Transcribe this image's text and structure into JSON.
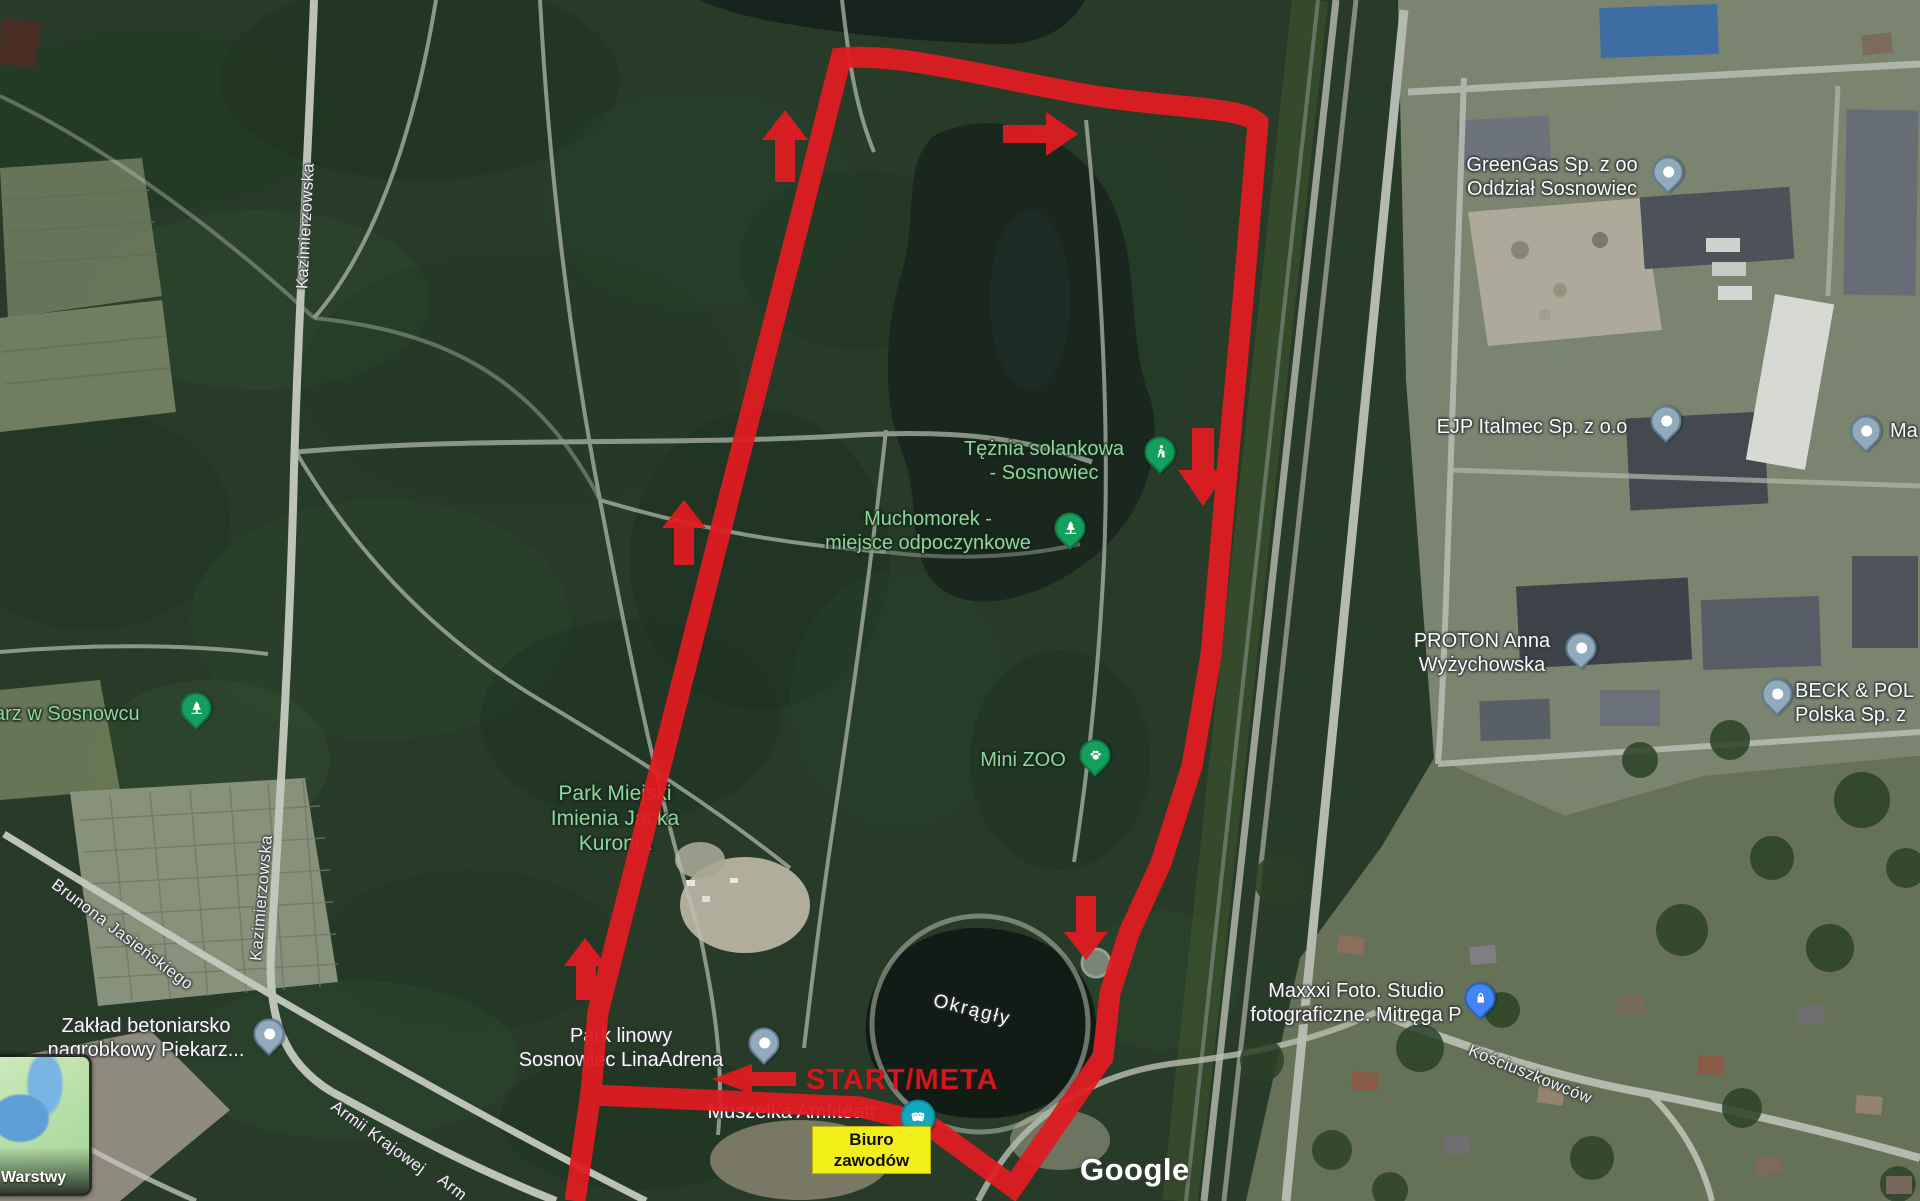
{
  "map": {
    "streets": {
      "kazimierzowska": "Kazimierzowska",
      "brunona_jasienskiego": "Brunona Jasieńskiego",
      "armii_krajowej": "Armii Krajowej",
      "armii_partial": "Arm",
      "kosciuszkowcow": "Kościuszkowców"
    },
    "places": {
      "greengas": {
        "line1": "GreenGas Sp. z oo",
        "line2": "Oddział Sosnowiec"
      },
      "ejp": {
        "line1": "EJP Italmec Sp. z o.o"
      },
      "ma_partial": {
        "line1": "Ma"
      },
      "proton": {
        "line1": "PROTON Anna",
        "line2": "Wyżychowska"
      },
      "beck": {
        "line1": "BECK & POL",
        "line2": "Polska Sp. z"
      },
      "maxxxi": {
        "line1": "Maxxxi Foto. Studio",
        "line2": "fotograficzne. Mitręga P"
      },
      "zaklad": {
        "line1": "Zakład betoniarsko",
        "line2": "nagrobkowy Piekarz..."
      },
      "cmentarz_partial": {
        "line1": "arz w Sosnowcu"
      },
      "teznia": {
        "line1": "Tężnia solankowa",
        "line2": "- Sosnowiec"
      },
      "muchomorek": {
        "line1": "Muchomorek -",
        "line2": "miejsce odpoczynkowe"
      },
      "mini_zoo": {
        "line1": "Mini ZOO"
      },
      "park_miejski": {
        "line1": "Park Miejski",
        "line2": "Imienia Jacka",
        "line3": "Kuronia"
      },
      "park_linowy": {
        "line1": "Park linowy",
        "line2": "Sosnowiec LinaAdrena"
      },
      "muszelka": {
        "line1": "Muszelka Amfiteatr"
      },
      "okragly": {
        "line1": "Okrągły"
      }
    }
  },
  "route_overlay": {
    "start_finish_label": "START/META",
    "race_office": {
      "line1": "Biuro",
      "line2": "zawodów"
    },
    "route_color": "#df1b22",
    "office_bg_color": "#f2ee1a"
  },
  "controls": {
    "layers_label": "Warstwy"
  },
  "attribution": {
    "logo": "Google"
  },
  "colors": {
    "poi_green_label": "#8ed69b",
    "pin_default": "#92abbc",
    "pin_green": "#12a05c",
    "pin_blue": "#4285f4",
    "theater_teal": "#12a7bc"
  }
}
